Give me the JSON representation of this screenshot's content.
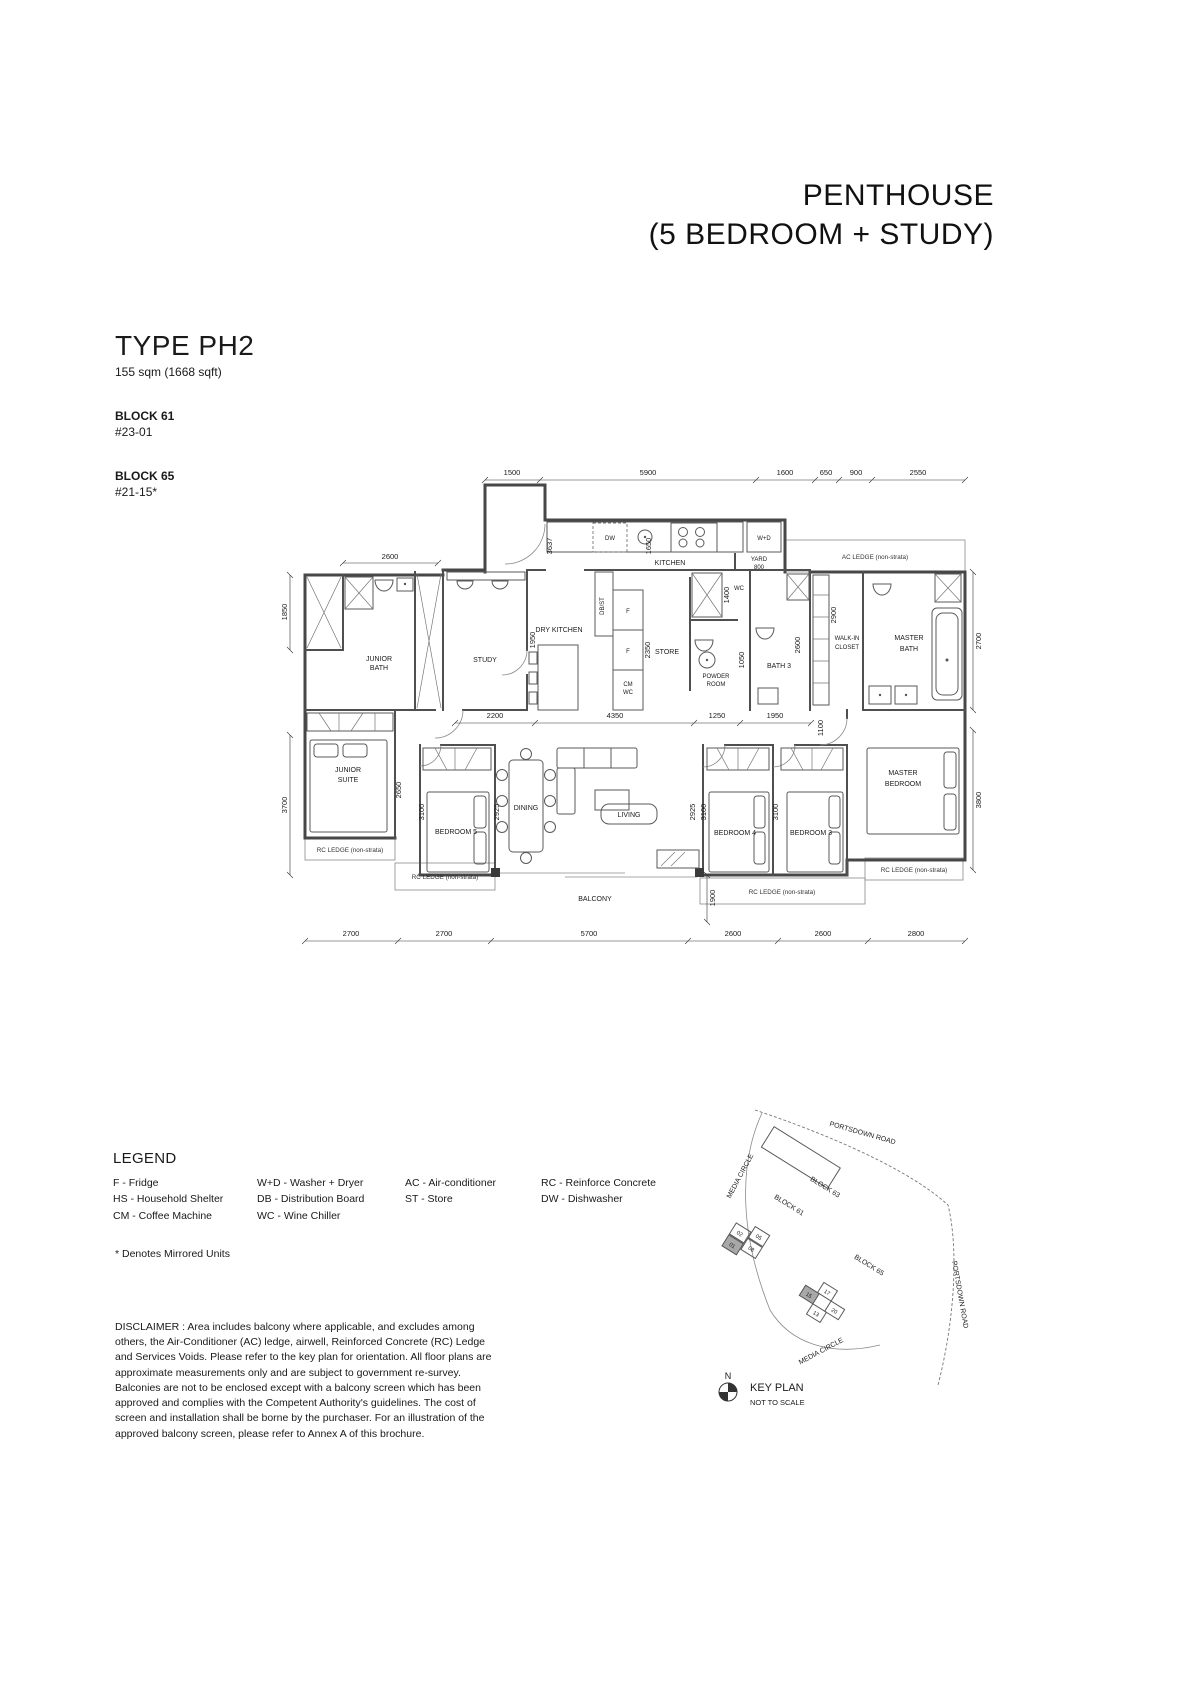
{
  "header": {
    "title_line1": "PENTHOUSE",
    "title_line2": "(5 BEDROOM + STUDY)"
  },
  "unit": {
    "type": "TYPE PH2",
    "area": "155 sqm (1668 sqft)",
    "blocks": [
      {
        "name": "BLOCK 61",
        "unit": "#23-01"
      },
      {
        "name": "BLOCK 65",
        "unit": "#21-15*"
      }
    ]
  },
  "plan": {
    "labels": {
      "junior_bath": [
        "JUNIOR",
        "BATH"
      ],
      "study": "STUDY",
      "dry_kitchen": "DRY KITCHEN",
      "db_st": "DB/ST",
      "kitchen": "KITCHEN",
      "dw": "DW",
      "wd": "W+D",
      "yard": [
        "YARD",
        "800"
      ],
      "ac_ledge": "AC LEDGE (non-strata)",
      "fridge": "F",
      "cm": "CM",
      "wine_chiller": "WC",
      "store": "STORE",
      "powder_room": [
        "POWDER",
        "ROOM"
      ],
      "wc": "WC",
      "bath3": "BATH 3",
      "walk_in_closet": [
        "WALK-IN",
        "CLOSET"
      ],
      "master_bath": [
        "MASTER",
        "BATH"
      ],
      "junior_suite": [
        "JUNIOR",
        "SUITE"
      ],
      "bedroom5": "BEDROOM 5",
      "dining": "DINING",
      "living": "LIVING",
      "bedroom4": "BEDROOM 4",
      "bedroom3": "BEDROOM 3",
      "master_bedroom": [
        "MASTER",
        "BEDROOM"
      ],
      "balcony": "BALCONY",
      "rc_ledge": "RC LEDGE (non-strata)"
    },
    "dims": {
      "top": [
        "1500",
        "5900",
        "1600",
        "650",
        "900",
        "2550"
      ],
      "bottom": [
        "2700",
        "2700",
        "5700",
        "2600",
        "2600",
        "2800"
      ],
      "left": [
        "1850",
        "3700"
      ],
      "right": [
        "2700",
        "3800"
      ],
      "middle": [
        "2200",
        "4350",
        "1250",
        "1950"
      ],
      "inner": {
        "junior_bath_w": "2600",
        "study": "1950",
        "entry": "3637",
        "kitchen": "1650",
        "store": "2350",
        "shaft": "1400",
        "powder": "1050",
        "bath3": "2600",
        "walk_in": "2900",
        "hall": "1100",
        "junior_suite": "2650",
        "bedroom5": "3100",
        "dining": "2925",
        "living": "2925",
        "bedroom4": "3100",
        "bedroom3": "3100",
        "balcony": "1900"
      }
    }
  },
  "legend": {
    "title": "LEGEND",
    "columns": [
      [
        "F - Fridge",
        "HS - Household Shelter",
        "CM - Coffee Machine"
      ],
      [
        "W+D - Washer + Dryer",
        "DB - Distribution Board",
        "WC - Wine Chiller"
      ],
      [
        "AC  - Air-conditioner",
        "ST - Store"
      ],
      [
        "RC - Reinforce Concrete",
        "DW - Dishwasher"
      ]
    ]
  },
  "notes": {
    "mirrored": "* Denotes Mirrored Units",
    "disclaimer": "DISCLAIMER : Area includes balcony where applicable, and excludes among others, the Air-Conditioner (AC) ledge, airwell, Reinforced Concrete (RC) Ledge and Services Voids. Please refer to the key plan for orientation. All floor plans are approximate measurements only and are subject to government re-survey. Balconies are not to be enclosed except with a balcony screen which has been approved and complies with the Competent Authority's guidelines. The cost of screen and installation shall be borne by the purchaser. For an illustration of the approved balcony screen, please refer to Annex A of this brochure."
  },
  "keyplan": {
    "title": "KEY PLAN",
    "subtitle": "NOT TO SCALE",
    "north": "N",
    "road_portsdown_top": "PORTSDOWN ROAD",
    "road_portsdown_right": "PORTSDOWN ROAD",
    "road_media_left": "MEDIA CIRCLE",
    "road_media_bottom": "MEDIA CIRCLE",
    "block63": "BLOCK 63",
    "block61": "BLOCK 61",
    "block65": "BLOCK 65",
    "units_block61": [
      "05",
      "08",
      "02",
      "01"
    ],
    "units_block65": [
      "17",
      "20",
      "15",
      "13"
    ],
    "highlighted_units": [
      "01",
      "15"
    ],
    "highlight_color": "#a8a8a8"
  }
}
